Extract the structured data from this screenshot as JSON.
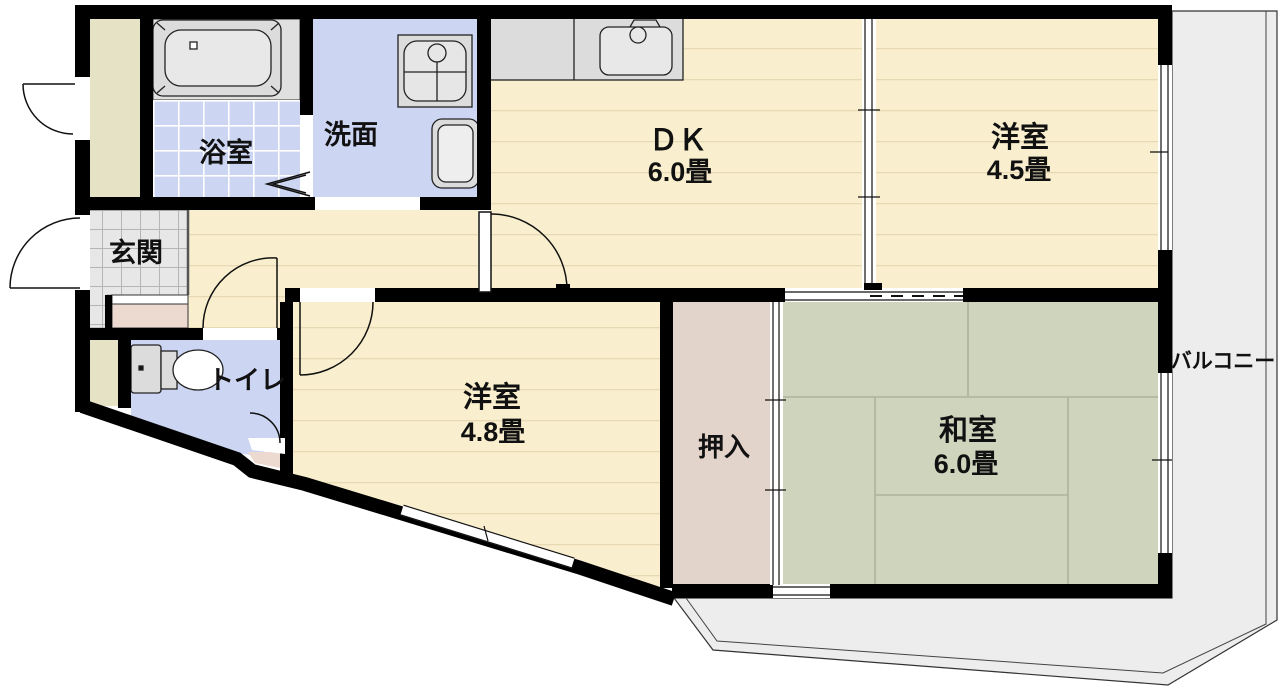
{
  "plan": {
    "title": "apartment-floor-plan",
    "rooms": [
      {
        "id": "bathroom",
        "label": "浴室",
        "size": ""
      },
      {
        "id": "washroom",
        "label": "洗面",
        "size": ""
      },
      {
        "id": "dining-kitchen",
        "label": "ＤＫ",
        "size": "6.0畳"
      },
      {
        "id": "western-room-45",
        "label": "洋室",
        "size": "4.5畳"
      },
      {
        "id": "entrance",
        "label": "玄関",
        "size": ""
      },
      {
        "id": "toilet",
        "label": "トイレ",
        "size": ""
      },
      {
        "id": "western-room-48",
        "label": "洋室",
        "size": "4.8畳"
      },
      {
        "id": "closet",
        "label": "押入",
        "size": ""
      },
      {
        "id": "japanese-room",
        "label": "和室",
        "size": "6.0畳"
      },
      {
        "id": "balcony",
        "label": "バルコニー",
        "size": ""
      }
    ],
    "colors": {
      "wall": "#000000",
      "wood_floor": "#f9eecd",
      "wood_floor_line": "#e6d9b3",
      "tatami": "#cfd4bd",
      "tatami_line": "#aeb49c",
      "wet_floor": "#ccd5f1",
      "entrance_tile": "#e7e7e7",
      "entrance_tile_line": "#b5b5b5",
      "closet_fill": "#e2d3cb",
      "storage_fill": "#e5e2c6",
      "balcony_fill": "#ededed",
      "fixture_fill": "#dcdcdc",
      "step_fill": "#ecd9d0"
    }
  }
}
